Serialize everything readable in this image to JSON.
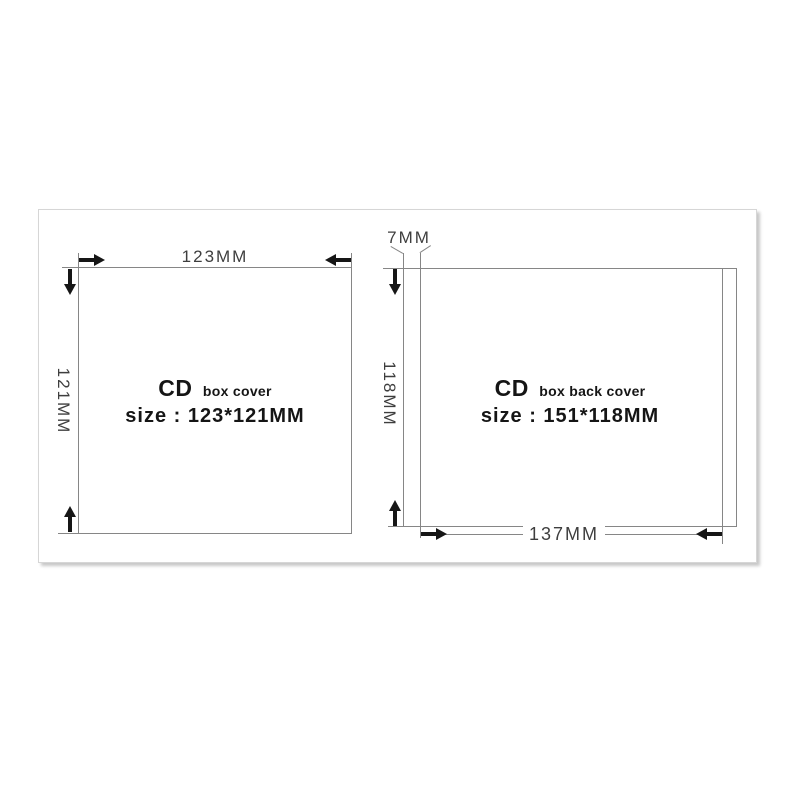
{
  "diagram": {
    "left_figure": {
      "name": "CD box cover",
      "title_main": "CD",
      "title_sub": "box cover",
      "size_text": "size : 123*121MM",
      "width_label": "123MM",
      "height_label": "121MM"
    },
    "right_figure": {
      "name": "CD box back cover",
      "title_main": "CD",
      "title_sub": "box back cover",
      "size_text": "size : 151*118MM",
      "spine_label": "7MM",
      "height_label": "118MM",
      "inner_width_label": "137MM"
    },
    "colors": {
      "line": "#868686",
      "arrow": "#161616",
      "dimension_text": "#3e3e3e",
      "title_text": "#151515",
      "panel_border": "#d6d6d6",
      "panel_background": "#ffffff"
    }
  }
}
